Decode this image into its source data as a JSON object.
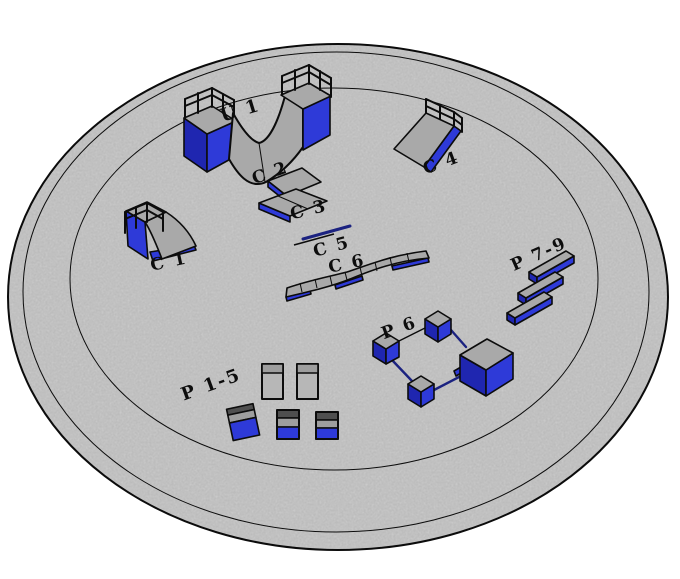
{
  "scene": {
    "description": "3D plan view of a circular skatepark platform with labeled ramps, boxes and rails",
    "background": "#ffffff"
  },
  "platform": {
    "rings": [
      "outer-edge",
      "rim-line",
      "inner-zone-line"
    ],
    "surface": "concrete"
  },
  "obstacles": [
    {
      "id": "U1",
      "label": "U 1",
      "type": "halfpipe-with-platforms"
    },
    {
      "id": "C1",
      "label": "C 1",
      "type": "quarterpipe"
    },
    {
      "id": "C2",
      "label": "C 2",
      "type": "low-box"
    },
    {
      "id": "C3",
      "label": "C 3",
      "type": "low-box"
    },
    {
      "id": "C4",
      "label": "C 4",
      "type": "bank-ramp"
    },
    {
      "id": "C5",
      "label": "C 5",
      "type": "flat-rail"
    },
    {
      "id": "C6",
      "label": "C 6",
      "type": "segmented-ledge"
    },
    {
      "id": "P1-5",
      "label": "P 1-5",
      "type": "pads-and-boxes"
    },
    {
      "id": "P6",
      "label": "P 6",
      "type": "boxes-linked-by-rails"
    },
    {
      "id": "P7-9",
      "label": "P 7-9",
      "type": "parallel-ledges"
    }
  ],
  "colors": {
    "ground": "#d3d3d3",
    "surface_gray": "#a9a9a9",
    "panel_gray": "#b7b7b7",
    "dark_gray": "#4f4f4f",
    "blue": "#2e3ad8",
    "blue_dark": "#1f26b0",
    "rail_navy": "#1b2280",
    "outline": "#0c0c0c",
    "background": "#ffffff"
  }
}
